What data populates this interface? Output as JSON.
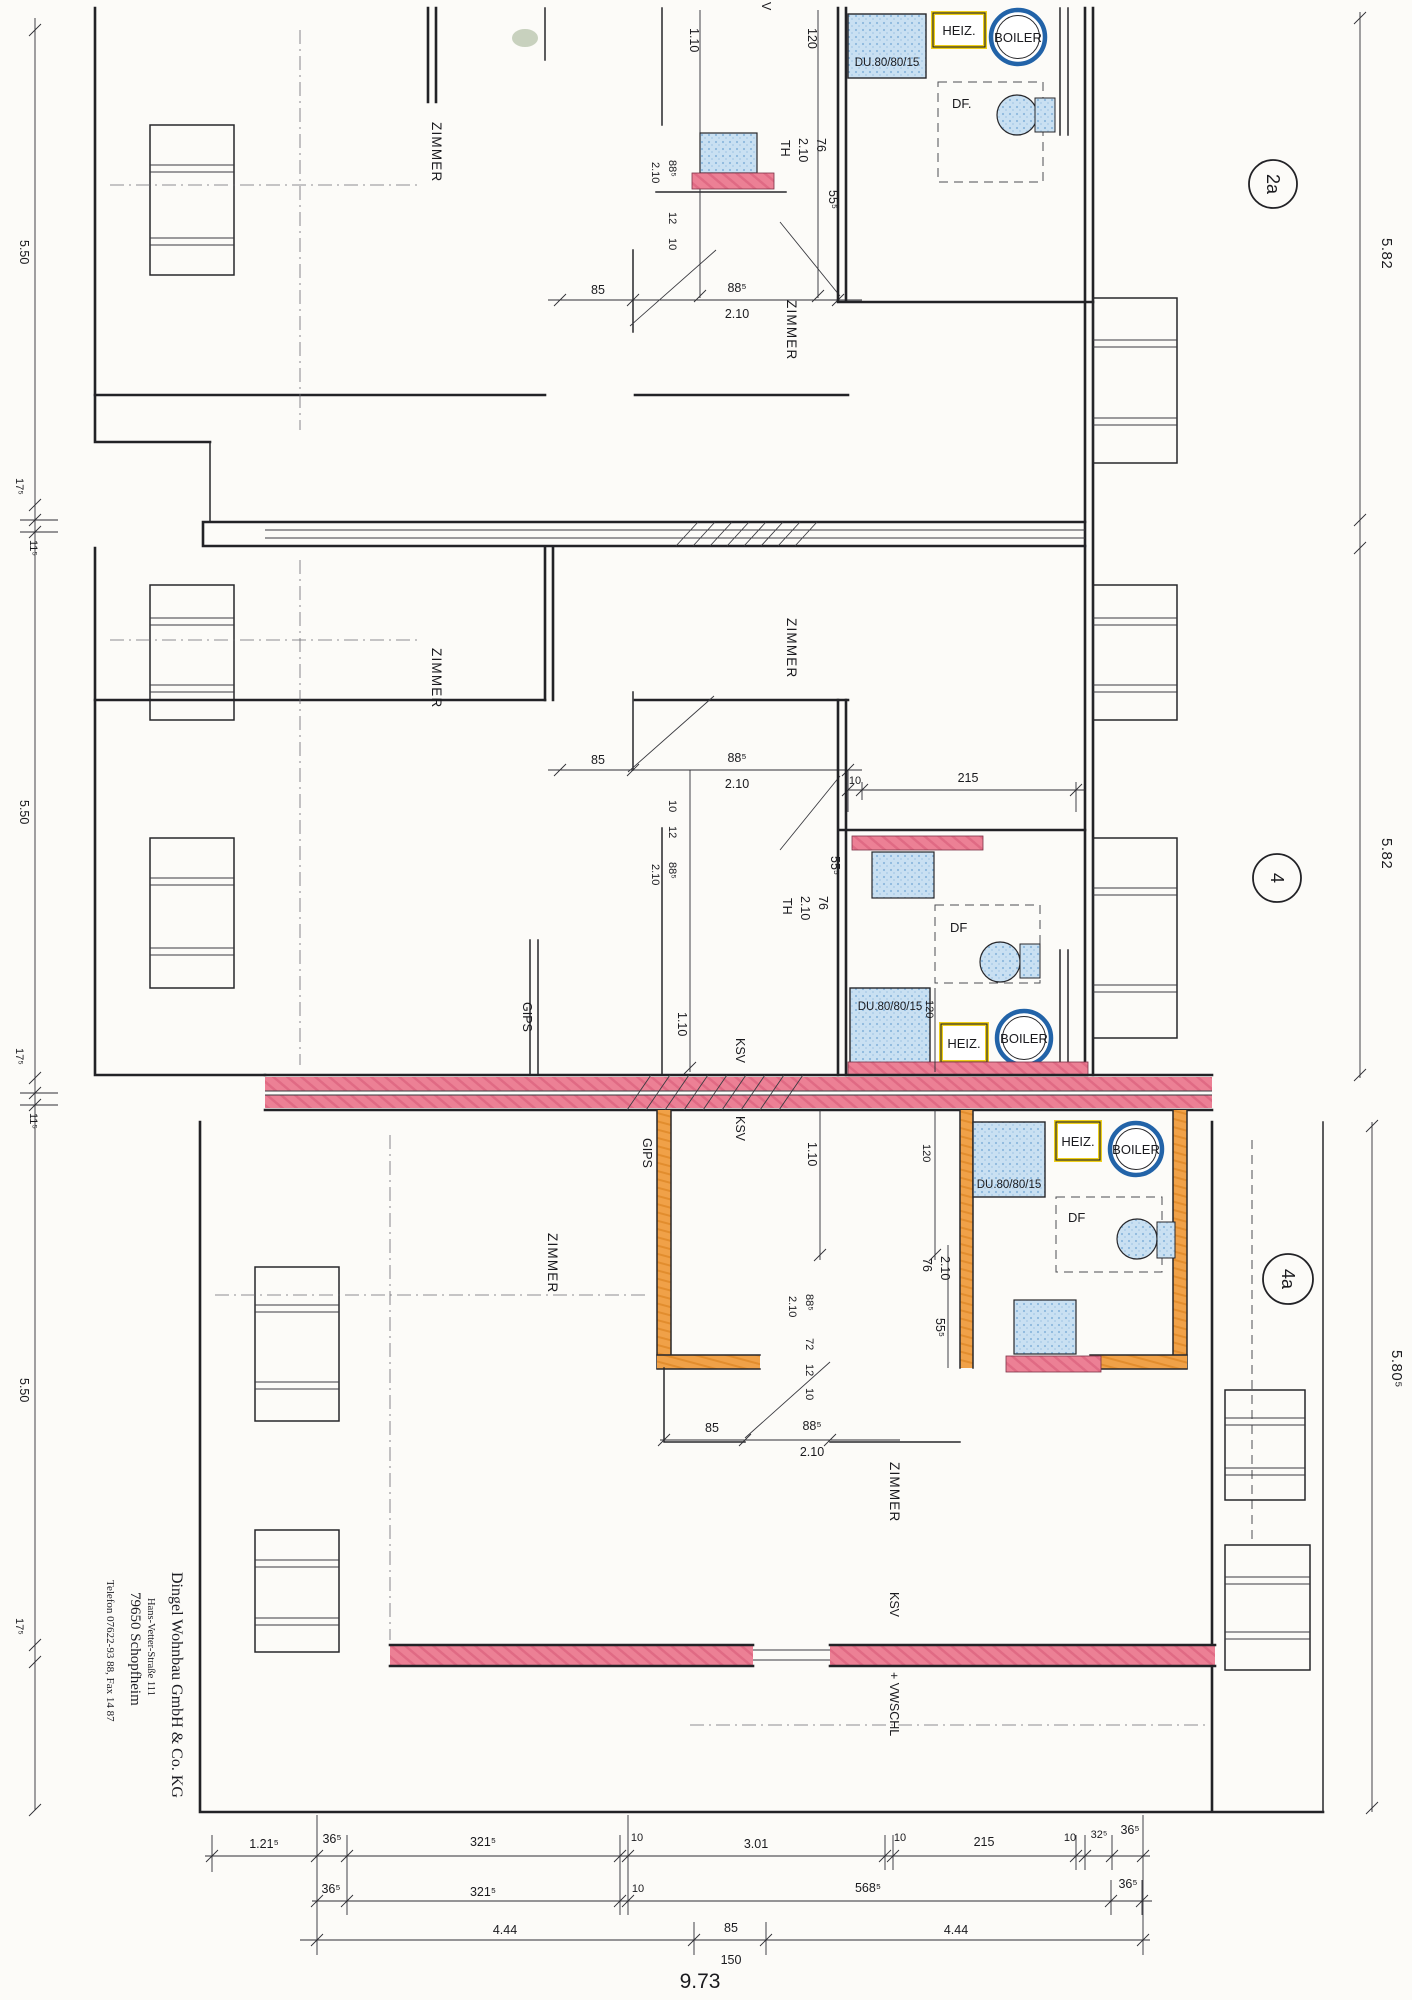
{
  "units": {
    "top": {
      "bubble": "2a",
      "height_dim": "5.82"
    },
    "middle": {
      "bubble": "4",
      "height_dim": "5.82"
    },
    "bottom": {
      "bubble": "4a",
      "height_dim": "5.80⁵"
    }
  },
  "rooms": {
    "zimmer": "ZIMMER"
  },
  "fixtures": {
    "shower": "DU.80/80/15",
    "heater": "HEIZ.",
    "boiler": "BOILER",
    "skylight": "DF.",
    "skylight_short": "DF"
  },
  "materials": {
    "gips": "GIPS",
    "ksv": "KSV",
    "vwschl": "+ VWSCHL",
    "partial_v": "V"
  },
  "dims": {
    "d110": "1.10",
    "d120": "120",
    "d210": "2.10",
    "d76": "76",
    "d555": "55⁵",
    "d85": "85",
    "d885": "88⁵",
    "d12": "12",
    "d10": "10",
    "d72": "72",
    "d215": "215",
    "th": "TH",
    "left": [
      "5.50",
      "17⁵",
      "11⁵",
      "5.50",
      "17⁵",
      "11⁵",
      "5.50",
      "17⁵"
    ],
    "row1": [
      "1.21⁵",
      "36⁵",
      "321⁵",
      "10",
      "3.01",
      "10",
      "215",
      "10",
      "32⁵",
      "36⁵"
    ],
    "row2": [
      "36⁵",
      "321⁵",
      "10",
      "568⁵",
      "36⁵"
    ],
    "row3": [
      "4.44",
      "85",
      "150",
      "4.44"
    ],
    "total": "9.73"
  },
  "stamp": {
    "company": "Dingel Wohnbau GmbH & Co. KG",
    "street": "Hans-Vetter-Straße 111",
    "city": "79650 Schopfheim",
    "phone": "Telefon 07622-93 88, Fax 14 87"
  },
  "colors": {
    "wall_pink": "#ec8095",
    "wall_orange": "#f0a148",
    "fixture_blue": "#c9e0f2",
    "heiz_yellow": "#eecf1a",
    "boiler_blue": "#2263a8"
  }
}
